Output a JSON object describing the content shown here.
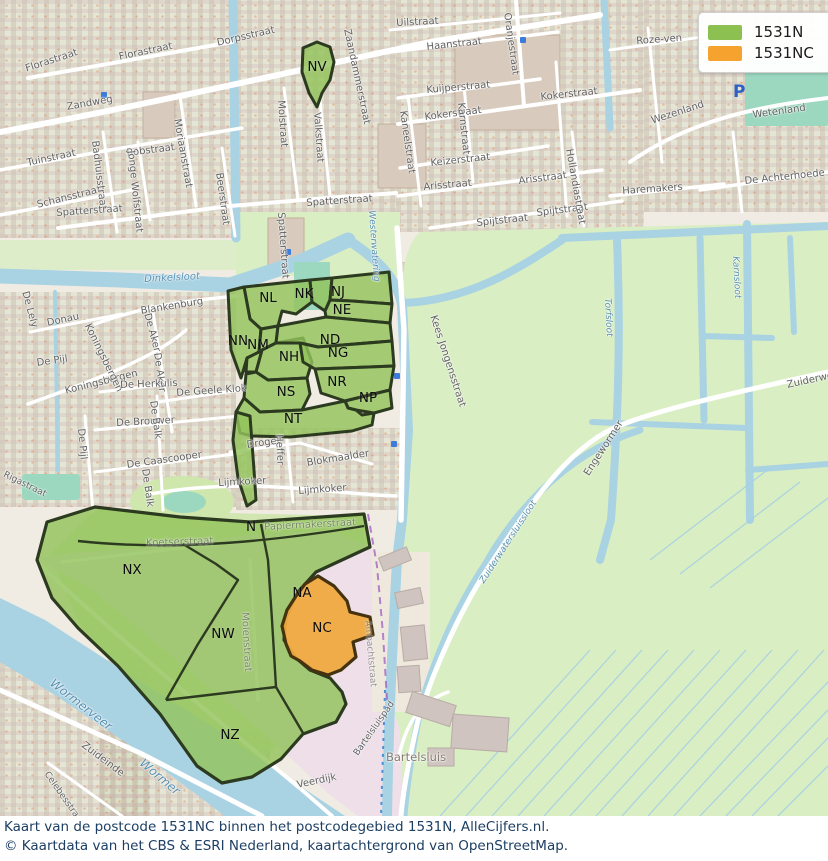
{
  "legend": {
    "items": [
      {
        "label": "1531N",
        "color": "#8cc152"
      },
      {
        "label": "1531NC",
        "color": "#f5a32e"
      }
    ]
  },
  "caption": {
    "line1": "Kaart van de postcode 1531NC binnen het postcodegebied 1531N, AlleCijfers.nl.",
    "line2": "© Kaartdata van het CBS & ESRI Nederland, kaartachtergrond van OpenStreetMap."
  },
  "areas": {
    "nv": "NV",
    "nl": "NL",
    "nk": "NK",
    "nj": "NJ",
    "ne": "NE",
    "nn": "NN",
    "nm": "NM",
    "nh": "NH",
    "nd": "ND",
    "ng": "NG",
    "nr": "NR",
    "np": "NP",
    "ns": "NS",
    "nt": "NT",
    "n": "N",
    "nx": "NX",
    "na": "NA",
    "nc": "NC",
    "nw": "NW",
    "nz": "NZ"
  },
  "streets": {
    "florastraat_a": "Florastraat",
    "florastraat_b": "Florastraat",
    "zandweg": "Zandweg",
    "dorpsstraat": "Dorpsstraat",
    "tuinstraat": "Tuinstraat",
    "schansstraat": "Schansstraat",
    "robstraat": "Robstraat",
    "badhuisstraat": "Badhuisstraat",
    "jonge_wolfstraat": "Jonge Wolfstraat",
    "moriaanstraat": "Moriaanstraat",
    "beerstraat": "Beerstraat",
    "molstraat": "Molstraat",
    "valkstraat": "Valkstraat",
    "zaandammerstraat": "Zaandammerstraat",
    "uilstraat": "Uilstraat",
    "haanstraat": "Haanstraat",
    "oranjestraat": "Oranjestraat",
    "kuijperstraat": "Kuijperstraat",
    "kokerstraat_a": "Kokerstraat",
    "kokerstraat_b": "Kokerstraat",
    "kaneelstraat": "Kaneelstraat",
    "karnstraat": "Karnstraat",
    "keizerstraat": "Keizerstraat",
    "arisstraat_a": "Arisstraat",
    "arisstraat_b": "Arisstraat",
    "spijtstraat_a": "Spijtstraat",
    "spijtstraat_b": "Spijtstraat",
    "hollandiastraat": "Hollandiastraat",
    "roze_ven": "Roze-ven",
    "wezenland": "Wezenland",
    "wetenland": "Wetenland",
    "haremakers": "Haremakers",
    "de_achterhoede": "De Achterhoede",
    "spatterstraat_a": "Spatterstraat",
    "spatterstraat_b": "Spatterstraat",
    "spatterstraat_c": "Spatterstraat",
    "blankenburg": "Blankenburg",
    "donau": "Donau",
    "de_lely": "De Lely",
    "koningsbergen_a": "Koningsbergen",
    "koningsbergen_b": "Koningsbergen",
    "de_pijl_a": "De Pijl",
    "de_pijl_b": "De Pijl",
    "de_aker_a": "De Aker",
    "de_aker_b": "De Aker",
    "de_herkulis": "De Herkulis",
    "de_geele_klok": "De Geele Klok",
    "de_brouwer": "De Brouwer",
    "de_balk_a": "De Balk",
    "de_balk_b": "De Balk",
    "de_caascooper": "De Caascooper",
    "rigastraat": "Rigastraat",
    "lijmkoker_a": "Lijmkoker",
    "lijmkoker_b": "Lijmkoker",
    "droger": "Droger",
    "heffer": "Heffer",
    "blokmaalder": "Blokmaalder",
    "papiermakerstraat": "Papiermakerstraat",
    "koetserstraat": "Koetserstraat",
    "molenstraat": "Molenstraat",
    "kees_jongensstraat": "Kees Jongensstraat",
    "zuideinde": "Zuideinde",
    "celebesstraat": "Celebesstraat",
    "veerdijk": "Veerdijk",
    "bartelsluispad": "Bartelsluispad",
    "engewormer": "Engewormer",
    "zuiderweg": "Zuiderweg",
    "ambachtstraat": "Ambachtstraat"
  },
  "water_labels": {
    "dinkelsloot": "Dinkelsloot",
    "westerwatering": "Westerwatering",
    "wormerveer": "Wormerveer",
    "wormer": "Wormer",
    "karnsloot": "Karnsloot",
    "torfsloot": "Torfsloot",
    "zuiderwatersluissloot": "Zuiderwatersluissloot"
  },
  "places": {
    "bartelsluis": "Bartelsluis",
    "parking": "P"
  }
}
